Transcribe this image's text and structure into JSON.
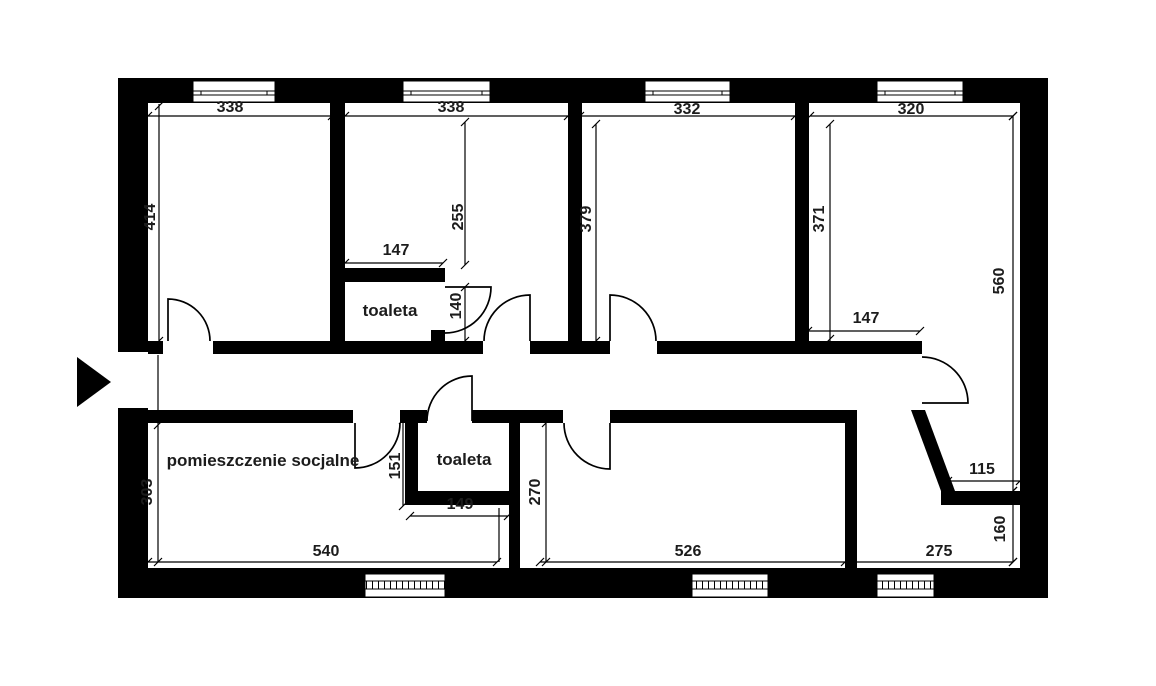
{
  "rooms": {
    "social_room": "pomieszczenie socjalne",
    "toilet_top": "toaleta",
    "toilet_bottom": "toaleta"
  },
  "dimensions": {
    "room1_width": "338",
    "room2_width": "338",
    "room3_width": "332",
    "room4_width": "320",
    "room1_depth": "414",
    "room2_depth": "255",
    "room3_depth": "379",
    "room4_depth": "371",
    "right_room_depth": "560",
    "toilet_top_width": "147",
    "toilet_top_depth": "140",
    "room4_bottom_width": "147",
    "social_room_depth": "303",
    "social_room_width": "540",
    "toilet_bottom_depth": "151",
    "toilet_bottom_width": "149",
    "bottom_room_depth": "270",
    "bottom_room_width": "526",
    "bottom_right_room_width": "275",
    "bottom_right_nook_width": "115",
    "bottom_right_nook_depth": "160"
  },
  "colors": {
    "wall": "#000000",
    "background": "#ffffff",
    "text": "#1c1c1c"
  }
}
